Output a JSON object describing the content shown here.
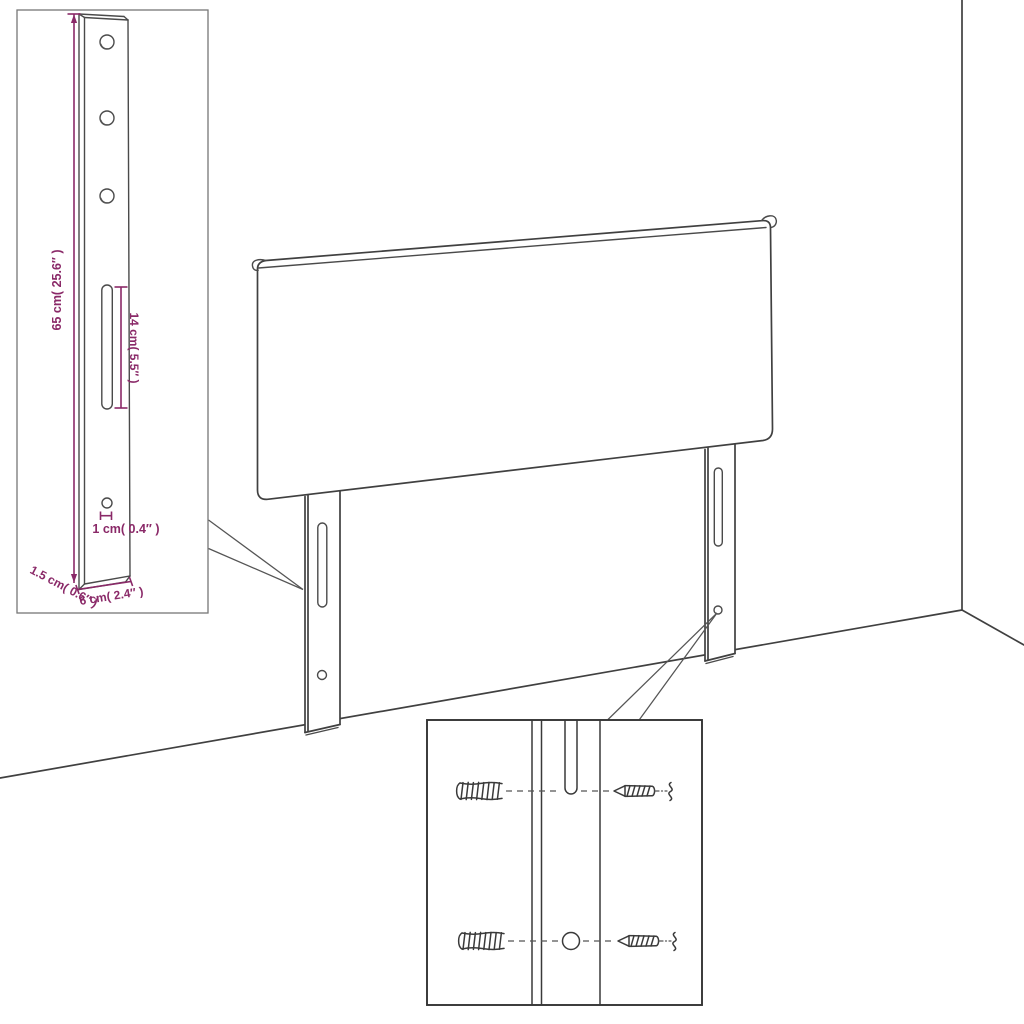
{
  "diagram": {
    "subject": "Upholstered headboard with two slotted mounting legs, wall corner scene, leg dimension inset and wall-fixing hardware inset",
    "colors": {
      "background": "#ffffff",
      "line_art": "#404040",
      "dimension_text": "#8a2968",
      "inset_border": "#777777",
      "hardware_inset_border": "#333333"
    },
    "leg_detail_inset": {
      "dim_height": "65 cm( 25.6″ )",
      "dim_slot": "14 cm( 5.5″ )",
      "dim_hole": "1 cm( 0.4″ )",
      "dim_thickness": "1.5 cm( 0.6″ )",
      "dim_width": "6 cm( 2.4″ )",
      "features": [
        "three round screw holes",
        "long adjustment slot",
        "small bottom hole"
      ]
    },
    "hardware_inset": {
      "items": [
        "wall plug (anchor)",
        "screw",
        "mounting slot",
        "pilot hole"
      ]
    }
  }
}
